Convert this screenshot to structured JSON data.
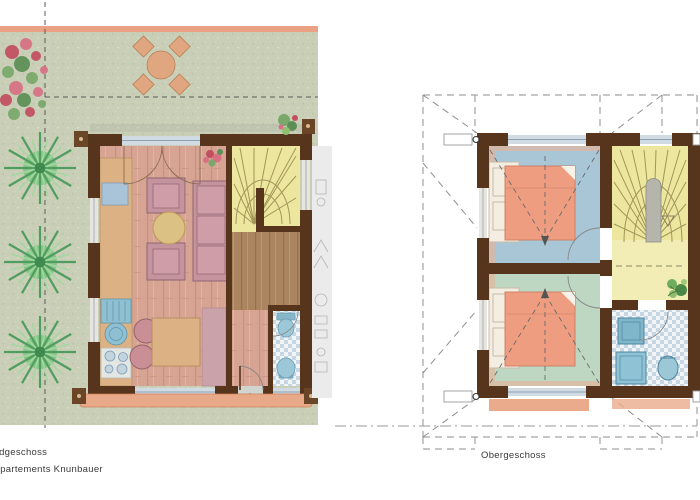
{
  "labels": {
    "ground_floor": "Erdgeschoss",
    "project": "Appartements Knunbauer",
    "upper_floor": "Obergeschoss"
  },
  "palette": {
    "garden_green": "#c9cfb7",
    "accent_strip_salmon": "#eba183",
    "wall_brown": "#57351d",
    "living_floor_pink": "#d7a493",
    "hall_wood_brown": "#ab8560",
    "stair_yellow": "#ece69f",
    "landing_yellow": "#f2edb4",
    "bath_tile_blue": "#c6d7e3",
    "fixture_blue": "#8fc0d2",
    "bedroom1_floor_blue": "#a9c6d6",
    "bedroom2_floor_green": "#bdd7c3",
    "bed_salmon": "#ee9d81",
    "sofa_mauve": "#c5939e",
    "wood_table_tan": "#dcb285",
    "walkway_salmon": "#e8a988",
    "tree_green": "#4f9e5f",
    "dashed_line_gray": "#8f8f8f"
  },
  "ground_floor": {
    "rooms": [
      {
        "name": "living-dining-room",
        "floor_color": "#d7a493"
      },
      {
        "name": "kitchen",
        "floor_color": "#dcb285"
      },
      {
        "name": "stairwell",
        "floor_color": "#ece69f"
      },
      {
        "name": "hallway",
        "floor_color": "#ab8560"
      },
      {
        "name": "wc-bathroom",
        "floor_color": "#c6d7e3"
      }
    ],
    "exterior": [
      "garden",
      "terrace",
      "property-line-dashed",
      "trees",
      "flowering-shrub",
      "terrace-table",
      "terrace-chairs",
      "entrance-walkway",
      "entrance-arrow"
    ],
    "furniture": [
      "sofa",
      "armchair",
      "armchair",
      "coffee-table",
      "dining-table",
      "dining-chairs",
      "sideboard",
      "kitchen-sink",
      "kitchen-basin",
      "stove",
      "toilet",
      "washbasin",
      "potted-plant",
      "potted-plant"
    ]
  },
  "upper_floor": {
    "rooms": [
      {
        "name": "bedroom-1",
        "floor_color": "#a9c6d6"
      },
      {
        "name": "bedroom-2",
        "floor_color": "#bdd7c3"
      },
      {
        "name": "stair-landing",
        "floor_color": "#ece69f"
      },
      {
        "name": "bathroom",
        "floor_color": "#c6d7e3"
      }
    ],
    "annotations": [
      "roof-outline-dashed",
      "roof-slope-arrows",
      "section-marker-boxes",
      "dash-dot-line"
    ],
    "furniture": [
      "double-bed",
      "double-bed",
      "headboard-unit",
      "headboard-unit",
      "shower",
      "washbasin",
      "toilet",
      "potted-plant",
      "winder-stairs"
    ]
  }
}
